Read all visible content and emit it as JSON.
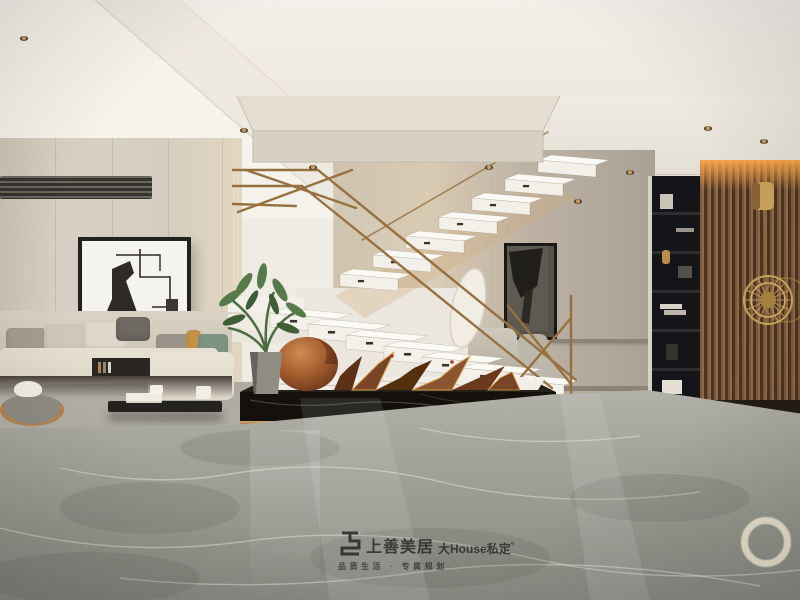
{
  "watermark": {
    "brand": "上善美居",
    "suffix": "大House私定",
    "degree": "°",
    "tagline": "品质生活 · 专属规划"
  },
  "palette": {
    "ceiling": "#f1ede6",
    "wall_beige": "#d5cec0",
    "wall_grey": "#aba196",
    "marble_floor": "#9aa099",
    "railing_bronze": "#96713f",
    "sculpture_copper": "#a35c2e",
    "wood_slat": "#6b4a33",
    "shelf_black": "#141519",
    "platform_black": "#15120e",
    "sofa_beige": "#ddd6c8",
    "pillow_green": "#7d9384",
    "pillow_mustard": "#c59145",
    "led_glow": "#f0a050",
    "step_white": "#f4f1ea"
  },
  "scene": {
    "type": "interior-photo",
    "objects": [
      "floating-marble-staircase",
      "bronze-glass-railing",
      "black-marble-platform",
      "copper-mountain-sculpture",
      "potted-plant",
      "l-shaped-sofa",
      "abstract-wall-art",
      "black-coffee-table",
      "round-side-tray",
      "grey-marble-floor",
      "wood-slat-wall",
      "gold-sunburst-sconce",
      "black-shelving-unit",
      "ac-vent",
      "recessed-downlights",
      "hallway-armchair",
      "ceiling-bulkhead"
    ]
  }
}
